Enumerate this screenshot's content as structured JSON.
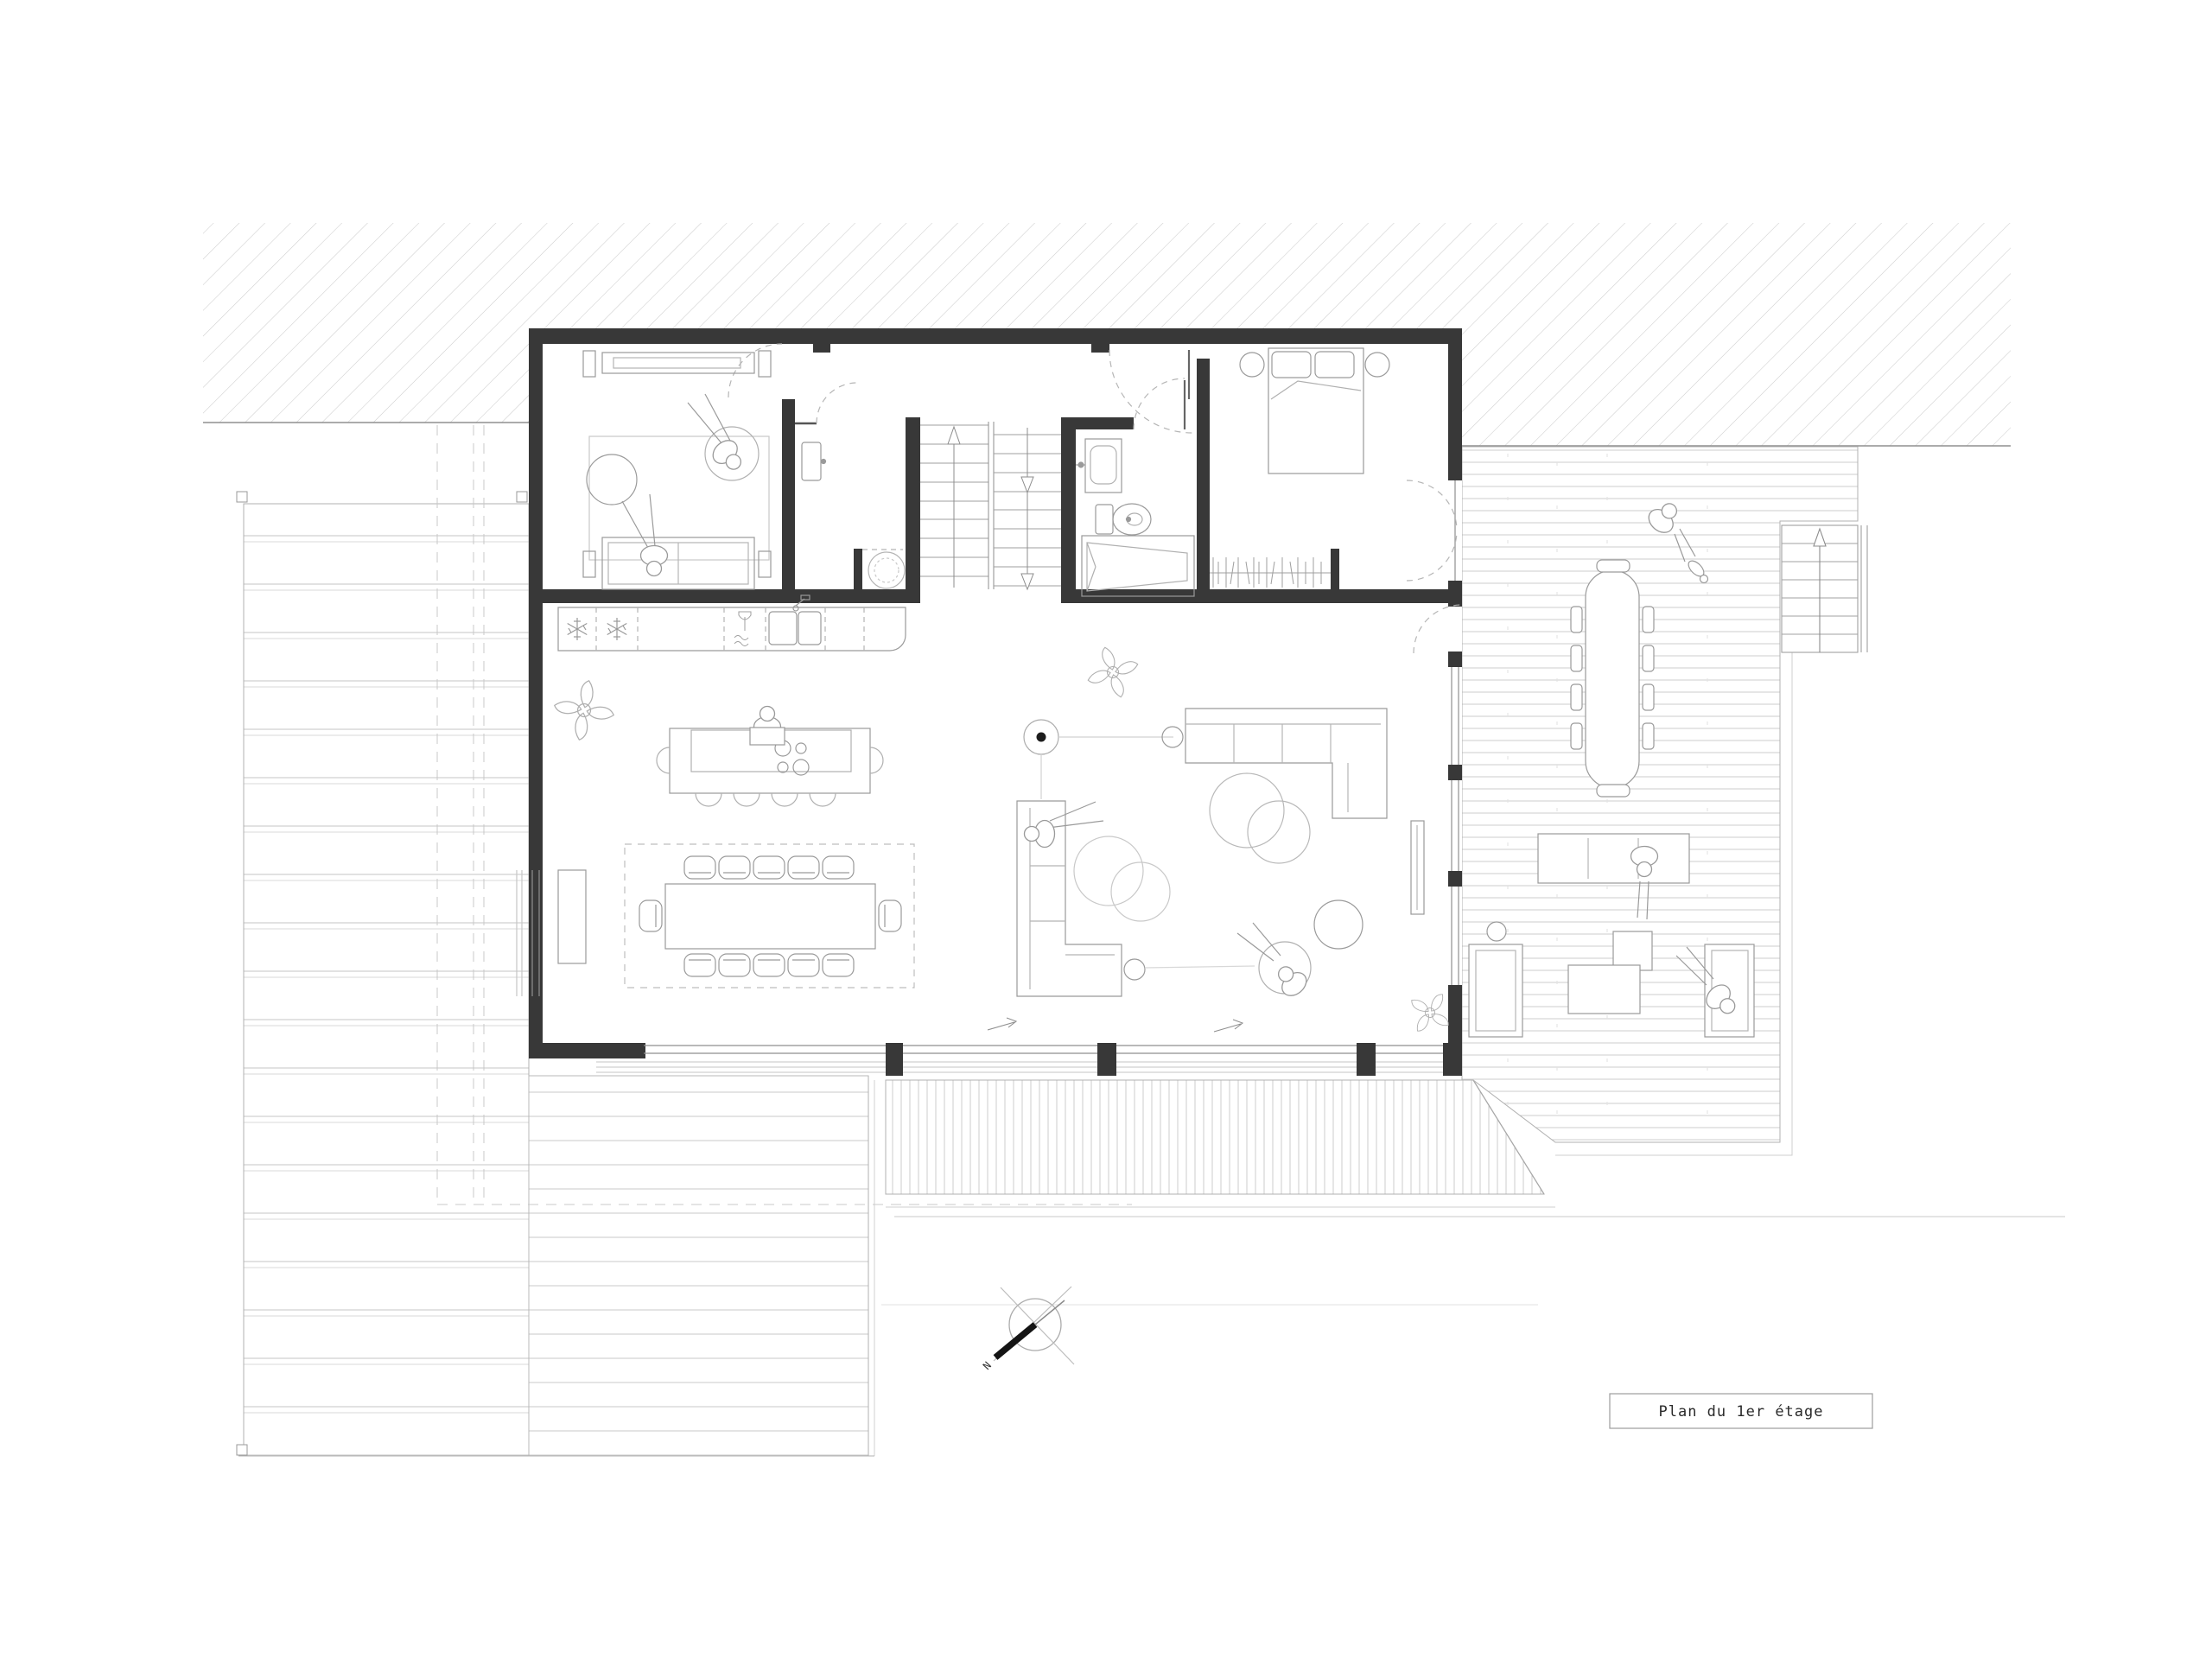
{
  "drawing": {
    "title_block": {
      "label": "Plan du 1er étage"
    },
    "compass": {
      "north_label": "N"
    }
  },
  "colors": {
    "background": "#ffffff",
    "wall": "#383838",
    "furniture_line": "#9a9a9a",
    "deck_plank_line": "#c6c6c6",
    "hatch_line": "#cdcdcd",
    "dashed_guide": "#b5b5b5",
    "text": "#2a2a2a"
  }
}
